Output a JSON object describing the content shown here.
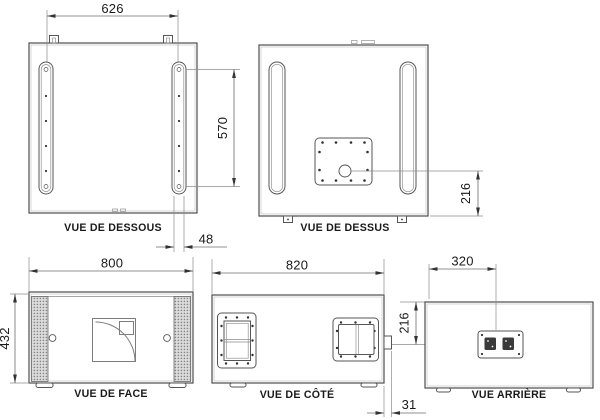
{
  "drawing": {
    "type": "technical-orthographic-views",
    "units": "mm",
    "colors": {
      "line": "#4d4d4d",
      "dim_line": "#6b6b6b",
      "text": "#1a1a1a",
      "grille": "#8f8f8f"
    },
    "views": {
      "bottom": {
        "label": "VUE DE DESSOUS",
        "dim_rail_spacing": "626",
        "dim_rail_length": "570",
        "dim_rail_width": "48"
      },
      "top": {
        "label": "VUE DE DESSUS",
        "dim_socket_to_rear": "216"
      },
      "front": {
        "label": "VUE DE FACE",
        "dim_width": "800",
        "dim_height": "432"
      },
      "side": {
        "label": "VUE DE CÔTÉ",
        "dim_depth": "820",
        "dim_connector_offset": "31"
      },
      "rear": {
        "label": "VUE ARRIÈRE",
        "dim_plate_from_left": "320",
        "dim_plate_from_top": "216"
      }
    }
  }
}
